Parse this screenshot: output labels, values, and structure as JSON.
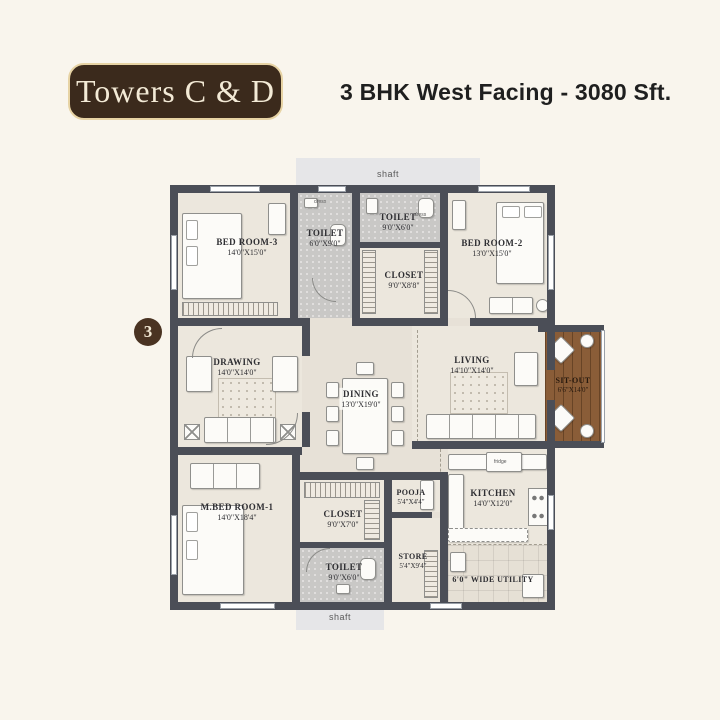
{
  "header": {
    "badge_label": "Towers C & D",
    "title": "3 BHK West Facing - 3080 Sft."
  },
  "plan": {
    "unit_number": "3",
    "shaft_top": "shaft",
    "shaft_bottom": "shaft",
    "rooms": {
      "bedroom3": {
        "name": "BED ROOM-3",
        "dim": "14'0\"X15'0\""
      },
      "toilet3": {
        "name": "TOILET",
        "dim": "6'0\"X9'0\""
      },
      "toilet2": {
        "name": "TOILET",
        "dim": "9'0\"X6'0\""
      },
      "closet2": {
        "name": "CLOSET",
        "dim": "9'0\"X8'8\""
      },
      "bedroom2": {
        "name": "BED ROOM-2",
        "dim": "13'0\"X15'0\""
      },
      "drawing": {
        "name": "DRAWING",
        "dim": "14'0\"X14'0\""
      },
      "dining": {
        "name": "DINING",
        "dim": "13'0\"X19'0\""
      },
      "living": {
        "name": "LIVING",
        "dim": "14'10\"X14'0\""
      },
      "sitout": {
        "name": "SIT-OUT",
        "dim": "6'6\"X14'0\""
      },
      "mbedroom1": {
        "name": "M.BED ROOM-1",
        "dim": "14'0\"X18'4\""
      },
      "closet1": {
        "name": "CLOSET",
        "dim": "9'0\"X7'0\""
      },
      "toilet1": {
        "name": "TOILET",
        "dim": "9'0\"X6'0\""
      },
      "pooja": {
        "name": "POOJA",
        "dim": "5'4\"X4'4\""
      },
      "store": {
        "name": "STORE",
        "dim": "5'4\"X9'4\""
      },
      "kitchen": {
        "name": "KITCHEN",
        "dim": "14'0\"X12'0\""
      },
      "utility": {
        "name": "6'0\" WIDE UTILITY"
      }
    },
    "annotations": {
      "fridge": "fridge",
      "dress_a": "dress",
      "dress_b": "dress"
    }
  },
  "colors": {
    "background": "#f9f5ed",
    "brand_brown": "#3b2a1c",
    "badge_border": "#e7d3a4",
    "badge_text": "#f3ead6",
    "title_text": "#1f1f1f",
    "wall": "#4b4e57",
    "floor": "#ece7dd",
    "toilet_floor": "#c9c8c6",
    "deck_wood": "#8a5d38"
  }
}
